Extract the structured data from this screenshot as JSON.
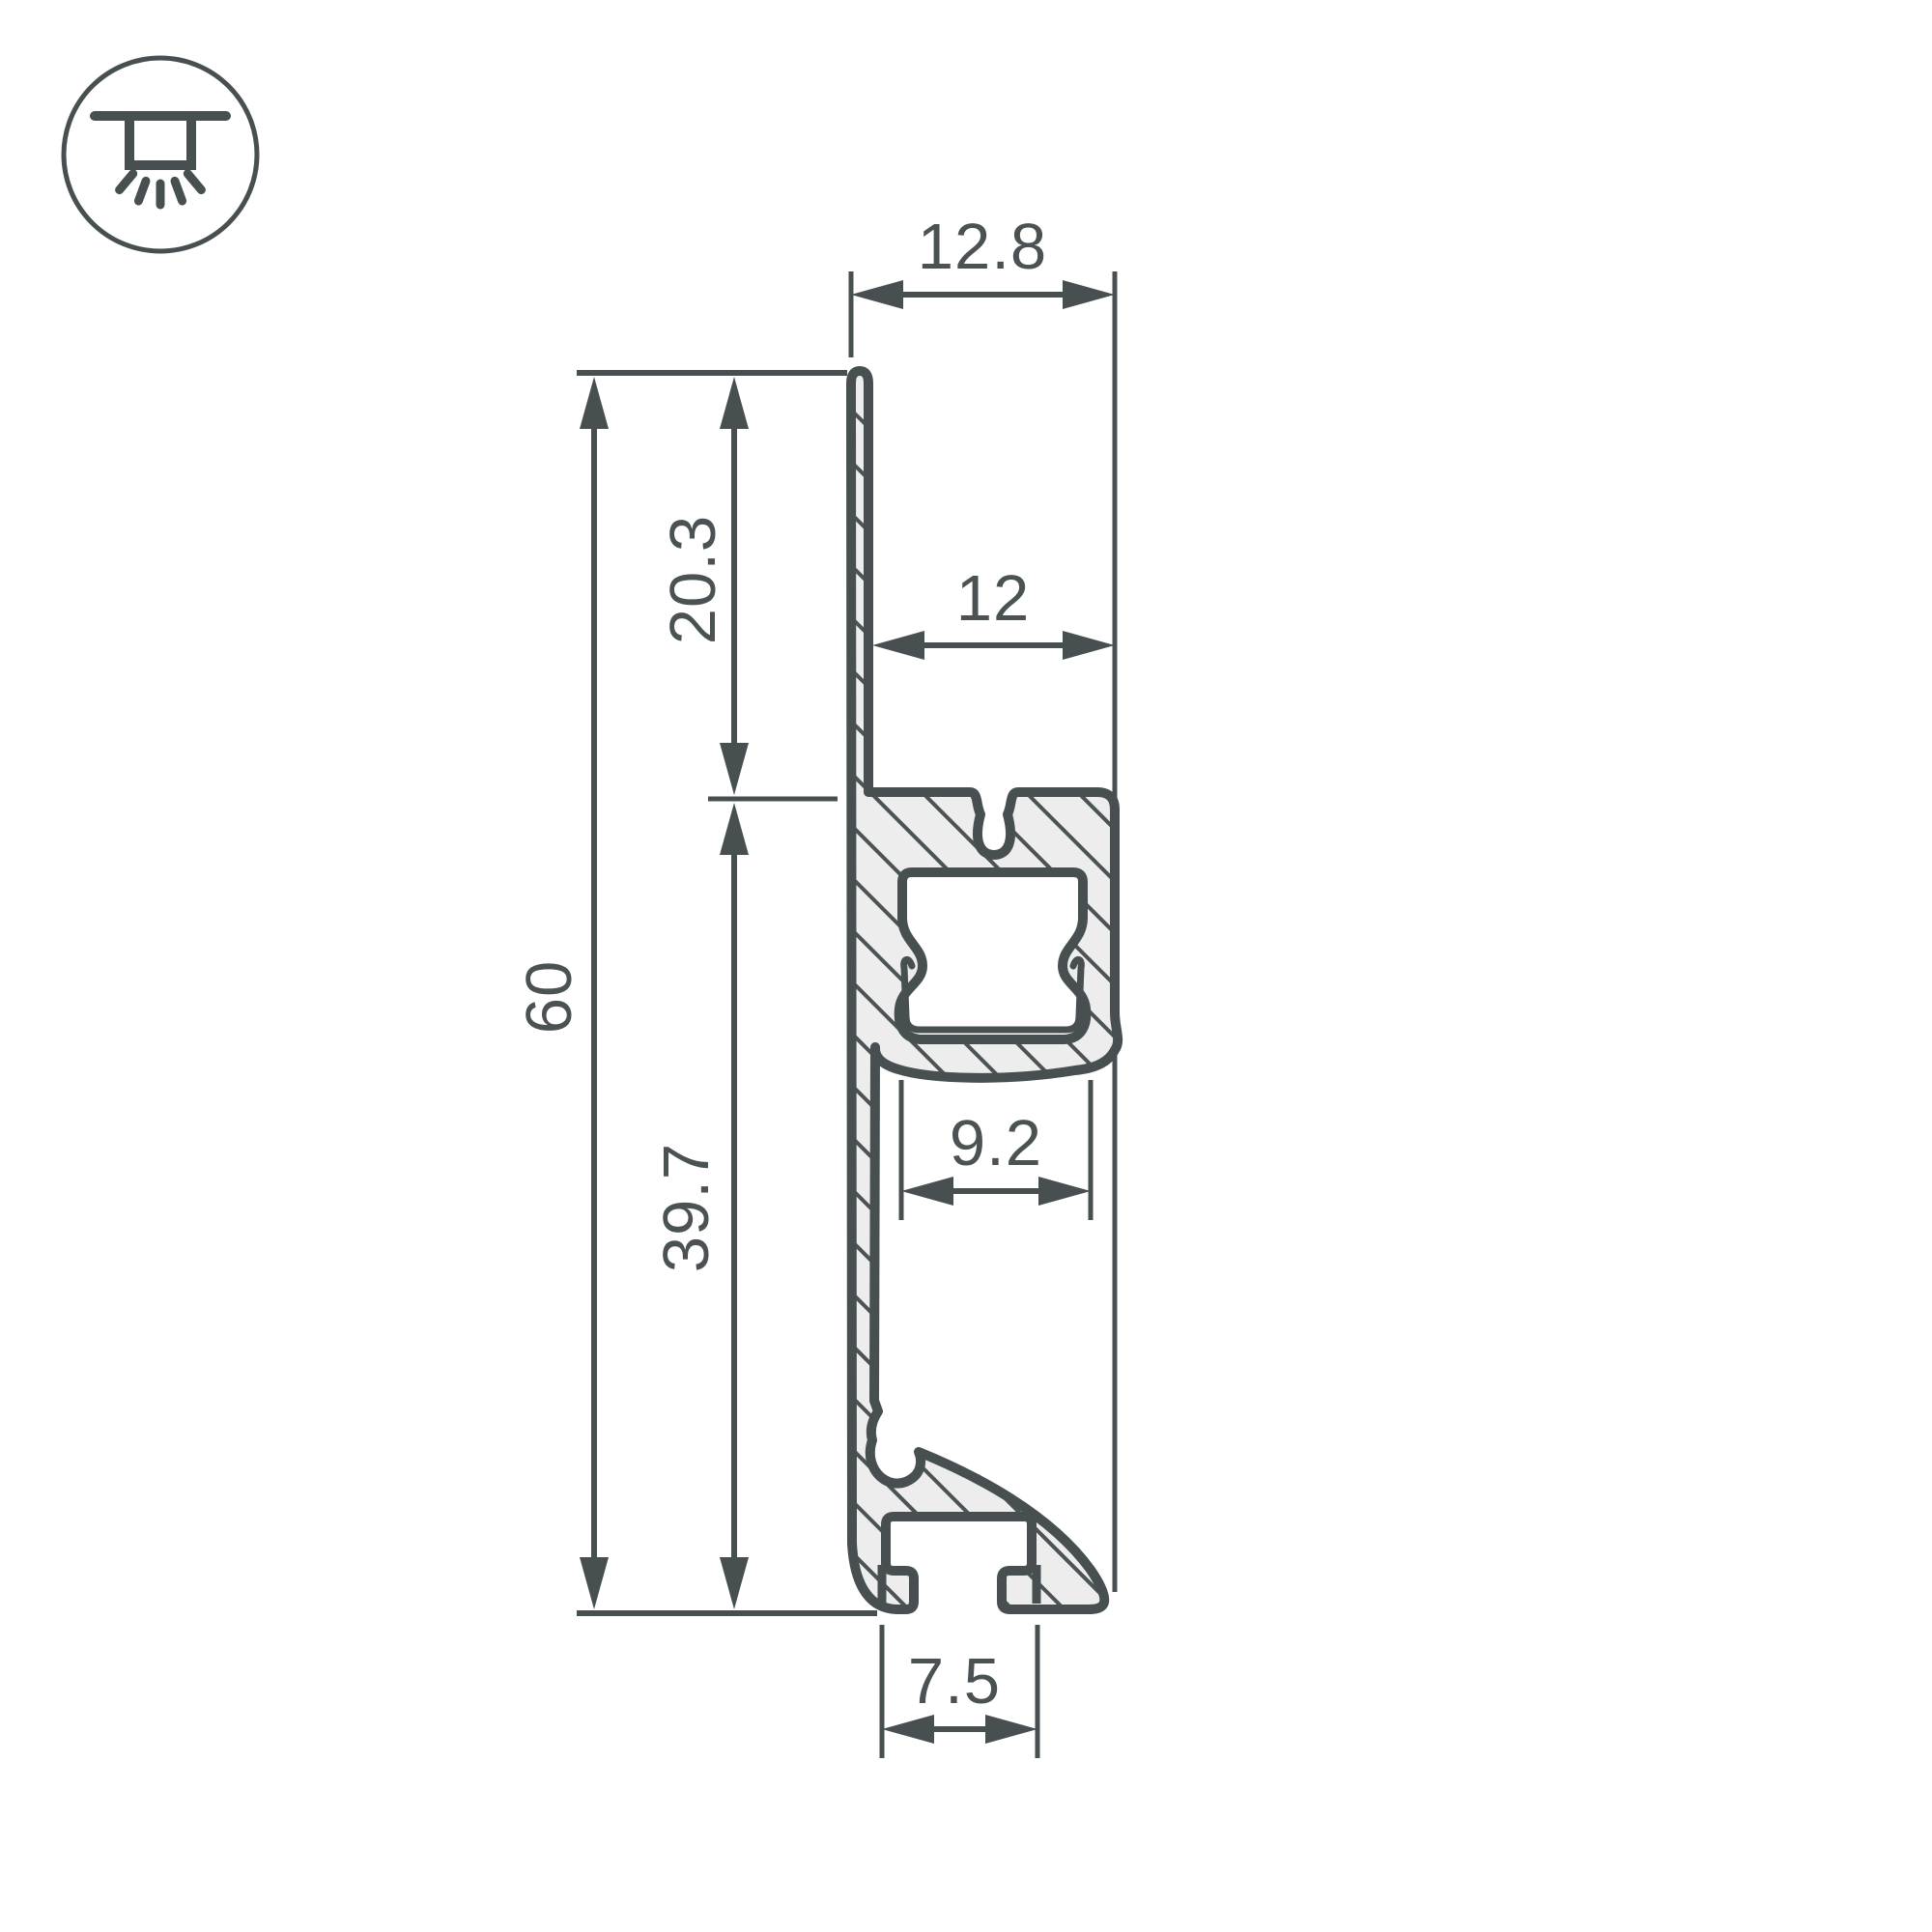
{
  "drawing": {
    "type": "led-profile-cross-section",
    "dimensions": {
      "top_width": "12.8",
      "upper_height": "20.3",
      "inner_width": "12",
      "total_height": "60",
      "lower_height": "39.7",
      "channel_width": "9.2",
      "foot_width": "7.5"
    }
  },
  "icon": {
    "name": "recessed-ceiling-light"
  },
  "colors": {
    "line": "#474F51",
    "material_fill": "#EDEDEE",
    "text": "#4A5254",
    "background": "#FFFFFF"
  }
}
